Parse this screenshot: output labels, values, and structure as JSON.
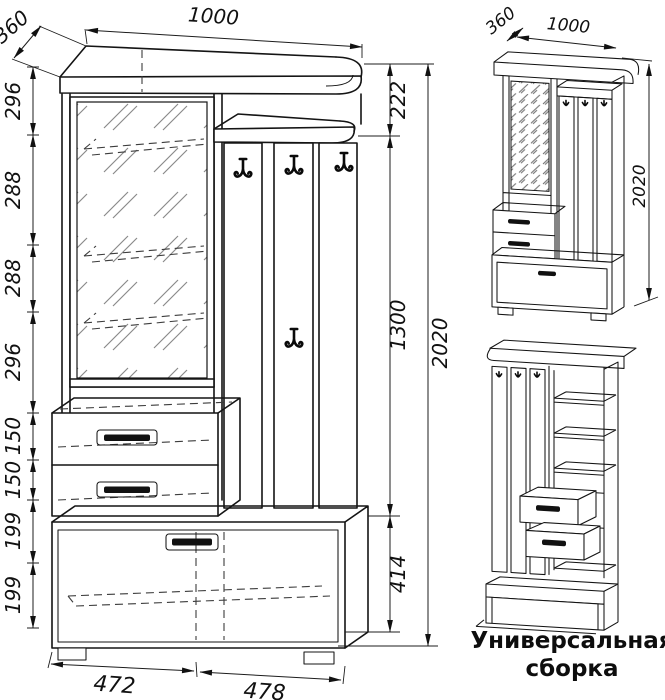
{
  "colors": {
    "line": "#141414",
    "background": "#ffffff"
  },
  "main_view": {
    "width_label": "1000",
    "depth_label": "360",
    "left_dims": [
      "296",
      "288",
      "288",
      "296",
      "150",
      "150",
      "199",
      "199"
    ],
    "right_dims": [
      "222",
      "1300",
      "414"
    ],
    "total_height_label": "2020",
    "bottom_dims": [
      "472",
      "478"
    ]
  },
  "assembled_view": {
    "depth_label": "360",
    "width_label": "1000",
    "height_label": "2020"
  },
  "caption": {
    "line1": "Универсальная",
    "line2": "сборка"
  }
}
